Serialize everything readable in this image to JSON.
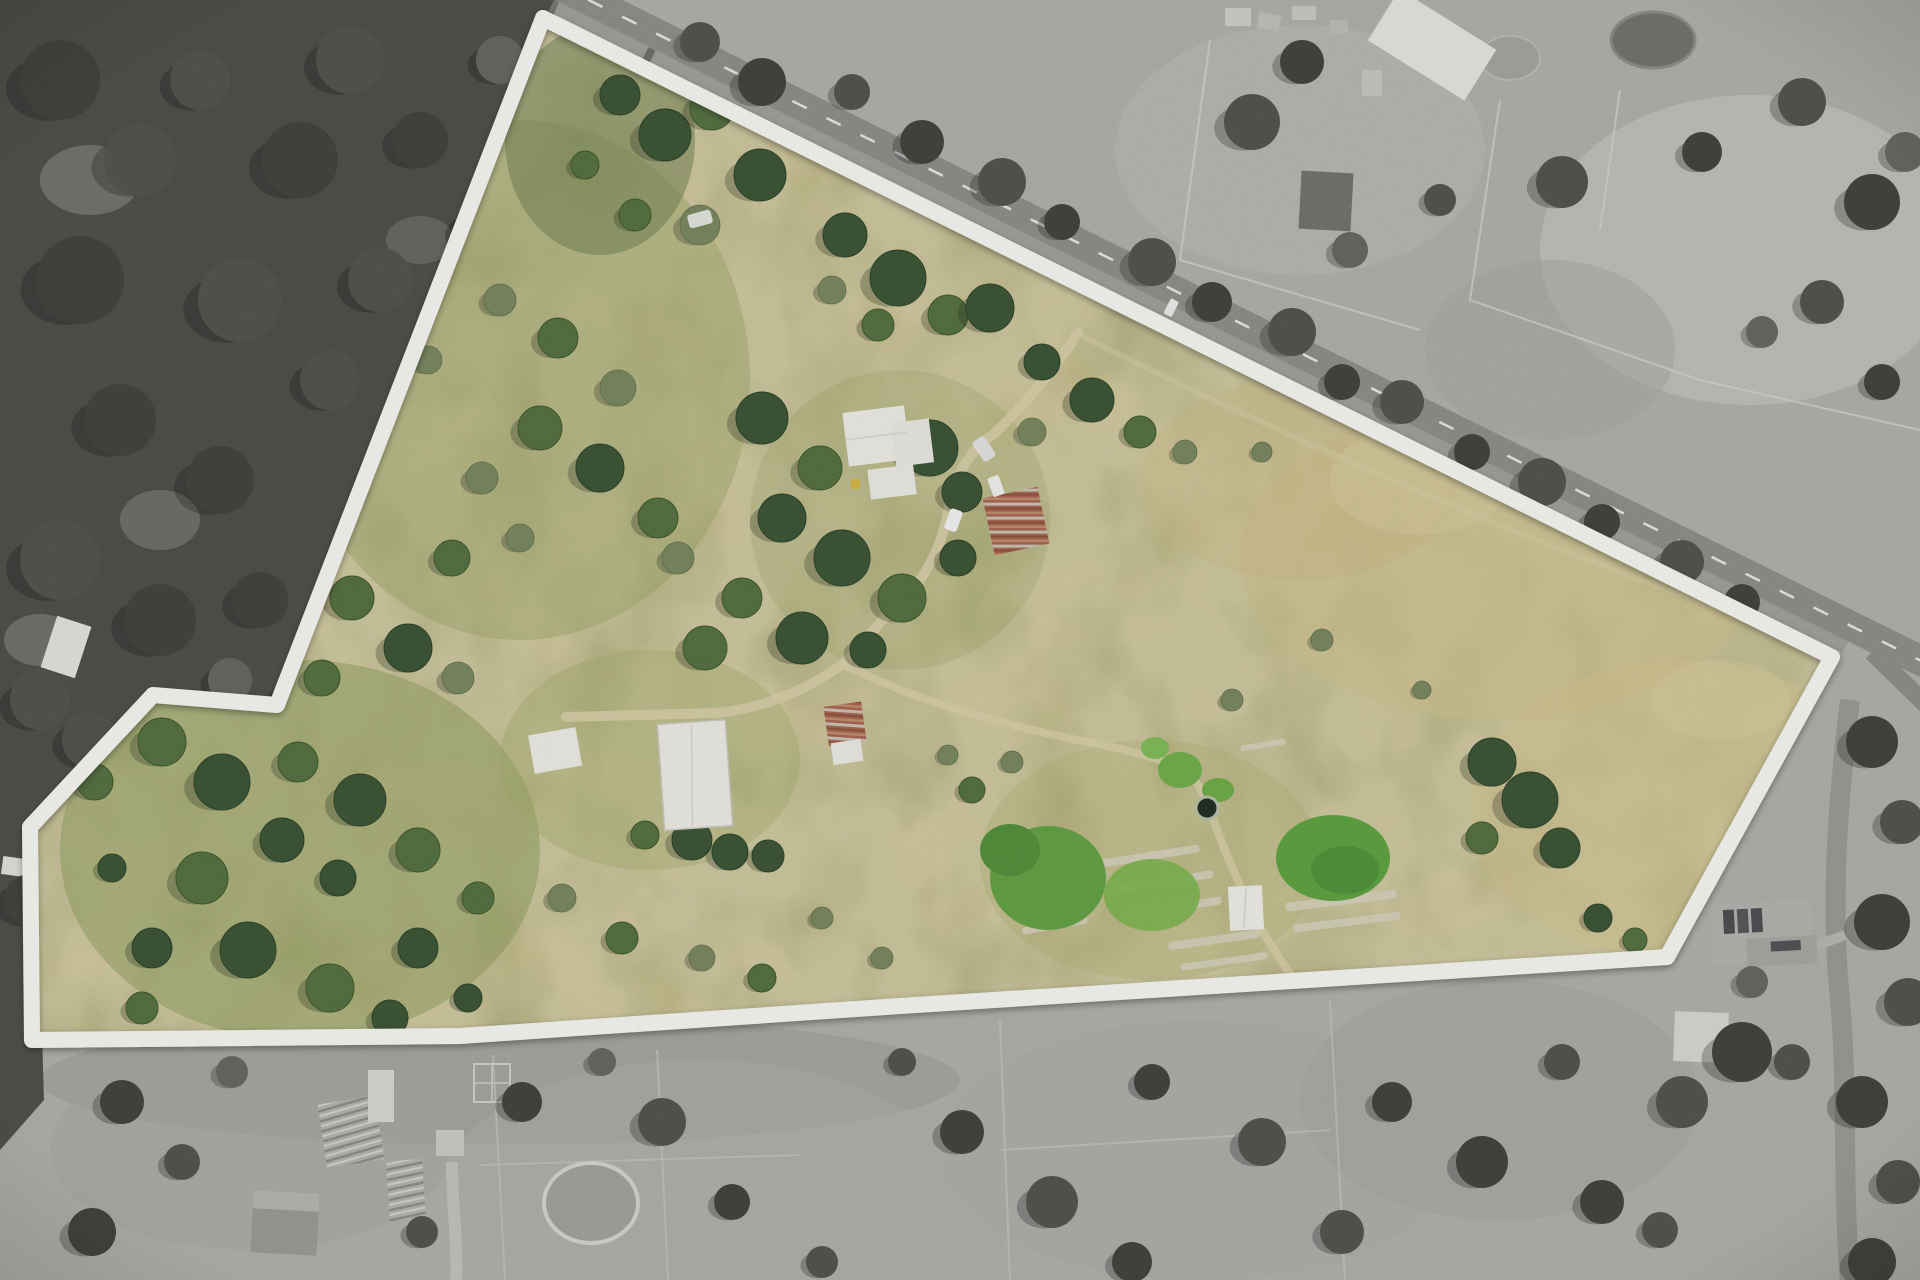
{
  "image": {
    "title": "Aerial drone photograph of a rural acreage lot; land inside the white marked boundary shown in colour, surrounding properties desaturated to greyscale",
    "kind": "real-estate aerial boundary photo"
  },
  "boundary": {
    "points": "543,18 1832,657 1667,957 900,1006 460,1036 32,1040 30,827 153,695 277,705",
    "stroke": "#fdfdf9",
    "stroke_width": 16
  },
  "palette": {
    "pasture_base": "#c6b67e",
    "pasture_dry": "#d6c68e",
    "pasture_olive": "#97a35e",
    "irrigated_green": "#58a338",
    "tree_dark": "#324f2b",
    "tree_mid": "#4e6d39",
    "scrub_grey_green": "#75855a",
    "track_tan": "#ddd2a8",
    "roof_white": "#f3f2ec",
    "rust_roof": "#a8604a",
    "outside_field": "#b3b1ac",
    "outside_forest": "#474743",
    "road_grey": "#8e8c88",
    "boundary_white": "#fdfdf9"
  },
  "features": [
    {
      "id": "boundary-outline",
      "label": "white surveyed property boundary"
    },
    {
      "id": "road-frontage",
      "label": "bitumen road along north-east boundary"
    },
    {
      "id": "main-house",
      "label": "white-roofed homestead with garage"
    },
    {
      "id": "rustic-shed-house",
      "label": "rusty corrugated shed beside homestead"
    },
    {
      "id": "big-barn",
      "label": "large white machinery barn"
    },
    {
      "id": "small-shed-west",
      "label": "small white shed west of barn"
    },
    {
      "id": "rustic-shed-mid",
      "label": "rusty shed with white lean-to mid paddock"
    },
    {
      "id": "garden-shed",
      "label": "small white garden shed"
    },
    {
      "id": "water-tank",
      "label": "round water tank beside garden"
    },
    {
      "id": "market-garden",
      "label": "irrigated green garden patches and crop beds"
    },
    {
      "id": "driveway",
      "label": "gravel driveway from road to homestead and barn"
    },
    {
      "id": "forest-west",
      "label": "dense bushland west of the lot (greyscale)"
    },
    {
      "id": "farm-complex-north",
      "label": "neighbouring farm buildings north of road (greyscale)"
    },
    {
      "id": "neighbour-house-east",
      "label": "neighbouring house with solar panels south-east (greyscale)"
    },
    {
      "id": "round-yard-south",
      "label": "round stock yard on southern neighbour (greyscale)"
    },
    {
      "id": "white-tarp",
      "label": "white tarp on ground near north boundary"
    },
    {
      "id": "cars",
      "label": "parked cars near homestead and on road"
    }
  ],
  "paths": {
    "driveway": "M1078,332 C1048,382 1008,420 994,434 C958,458 952,492 946,522 C936,560 918,586 903,600 C878,622 858,650 843,664 C798,696 758,708 718,713 L566,717",
    "garden_track": "M843,664 C918,702 1000,724 1078,740 C1138,752 1180,762 1196,782 C1210,802 1216,832 1230,862 C1244,896 1258,932 1298,984",
    "paddock_track": "M1082,336 C1252,422 1502,532 1702,602 C1762,624 1802,642 1824,656",
    "south_driveway": "M452,1162 C452,1205 458,1245 456,1285"
  },
  "trees": {
    "inside": [
      [
        620,
        95,
        20,
        "d"
      ],
      [
        665,
        135,
        26,
        "d"
      ],
      [
        712,
        108,
        22,
        "m"
      ],
      [
        760,
        175,
        26,
        "d"
      ],
      [
        700,
        225,
        20,
        "g"
      ],
      [
        635,
        215,
        16,
        "m"
      ],
      [
        585,
        165,
        14,
        "m"
      ],
      [
        845,
        235,
        22,
        "d"
      ],
      [
        898,
        278,
        28,
        "d"
      ],
      [
        948,
        315,
        20,
        "m"
      ],
      [
        878,
        325,
        16,
        "m"
      ],
      [
        990,
        308,
        24,
        "d"
      ],
      [
        832,
        290,
        14,
        "g"
      ],
      [
        1042,
        362,
        18,
        "d"
      ],
      [
        1092,
        400,
        22,
        "d"
      ],
      [
        1140,
        432,
        16,
        "m"
      ],
      [
        1032,
        432,
        14,
        "g"
      ],
      [
        1185,
        452,
        12,
        "g"
      ],
      [
        1262,
        452,
        10,
        "g"
      ],
      [
        500,
        300,
        16,
        "g"
      ],
      [
        558,
        338,
        20,
        "m"
      ],
      [
        618,
        388,
        18,
        "g"
      ],
      [
        540,
        428,
        22,
        "m"
      ],
      [
        482,
        478,
        16,
        "g"
      ],
      [
        600,
        468,
        24,
        "d"
      ],
      [
        658,
        518,
        20,
        "m"
      ],
      [
        520,
        538,
        14,
        "g"
      ],
      [
        452,
        558,
        18,
        "m"
      ],
      [
        678,
        558,
        16,
        "g"
      ],
      [
        428,
        360,
        14,
        "g"
      ],
      [
        762,
        418,
        26,
        "d"
      ],
      [
        820,
        468,
        22,
        "m"
      ],
      [
        930,
        448,
        28,
        "d"
      ],
      [
        962,
        492,
        20,
        "d"
      ],
      [
        782,
        518,
        24,
        "d"
      ],
      [
        842,
        558,
        28,
        "d"
      ],
      [
        902,
        598,
        24,
        "m"
      ],
      [
        958,
        558,
        18,
        "d"
      ],
      [
        742,
        598,
        20,
        "m"
      ],
      [
        802,
        638,
        26,
        "d"
      ],
      [
        868,
        650,
        18,
        "d"
      ],
      [
        705,
        648,
        22,
        "m"
      ],
      [
        692,
        840,
        20,
        "d"
      ],
      [
        730,
        852,
        18,
        "d"
      ],
      [
        768,
        856,
        16,
        "d"
      ],
      [
        645,
        835,
        14,
        "m"
      ],
      [
        162,
        742,
        24,
        "m"
      ],
      [
        222,
        782,
        28,
        "d"
      ],
      [
        298,
        762,
        20,
        "m"
      ],
      [
        360,
        800,
        26,
        "d"
      ],
      [
        282,
        840,
        22,
        "d"
      ],
      [
        202,
        878,
        26,
        "m"
      ],
      [
        338,
        878,
        18,
        "d"
      ],
      [
        418,
        850,
        22,
        "m"
      ],
      [
        152,
        948,
        20,
        "d"
      ],
      [
        248,
        950,
        28,
        "d"
      ],
      [
        330,
        988,
        24,
        "m"
      ],
      [
        418,
        948,
        20,
        "d"
      ],
      [
        478,
        898,
        16,
        "m"
      ],
      [
        142,
        1008,
        16,
        "m"
      ],
      [
        390,
        1018,
        18,
        "d"
      ],
      [
        468,
        998,
        14,
        "d"
      ],
      [
        95,
        782,
        18,
        "m"
      ],
      [
        112,
        868,
        14,
        "d"
      ],
      [
        352,
        598,
        22,
        "m"
      ],
      [
        408,
        648,
        24,
        "d"
      ],
      [
        322,
        678,
        18,
        "m"
      ],
      [
        458,
        678,
        16,
        "g"
      ],
      [
        1492,
        762,
        24,
        "d"
      ],
      [
        1530,
        800,
        28,
        "d"
      ],
      [
        1560,
        848,
        20,
        "d"
      ],
      [
        1482,
        838,
        16,
        "m"
      ],
      [
        1598,
        918,
        14,
        "d"
      ],
      [
        1635,
        940,
        12,
        "m"
      ],
      [
        1322,
        640,
        11,
        "g"
      ],
      [
        1422,
        690,
        9,
        "g"
      ],
      [
        1232,
        700,
        11,
        "g"
      ],
      [
        622,
        938,
        16,
        "m"
      ],
      [
        702,
        958,
        13,
        "g"
      ],
      [
        562,
        898,
        14,
        "g"
      ],
      [
        822,
        918,
        11,
        "g"
      ],
      [
        762,
        978,
        14,
        "m"
      ],
      [
        882,
        958,
        11,
        "g"
      ],
      [
        972,
        790,
        13,
        "m"
      ],
      [
        1012,
        762,
        11,
        "g"
      ],
      [
        948,
        755,
        10,
        "g"
      ]
    ],
    "outside": [
      [
        60,
        80,
        40,
        1
      ],
      [
        140,
        160,
        36,
        2
      ],
      [
        80,
        280,
        44,
        1
      ],
      [
        200,
        80,
        30,
        2
      ],
      [
        300,
        160,
        38,
        1
      ],
      [
        240,
        300,
        42,
        2
      ],
      [
        120,
        420,
        36,
        1
      ],
      [
        60,
        560,
        40,
        2
      ],
      [
        220,
        480,
        34,
        1
      ],
      [
        330,
        380,
        30,
        2
      ],
      [
        160,
        620,
        36,
        1
      ],
      [
        40,
        700,
        30,
        2
      ],
      [
        260,
        600,
        28,
        1
      ],
      [
        380,
        280,
        32,
        2
      ],
      [
        420,
        140,
        28,
        1
      ],
      [
        350,
        60,
        34,
        2
      ],
      [
        440,
        420,
        26,
        2
      ],
      [
        300,
        700,
        26,
        1
      ],
      [
        90,
        740,
        28,
        2
      ],
      [
        30,
        900,
        26,
        1
      ],
      [
        120,
        960,
        22,
        2
      ],
      [
        60,
        1010,
        20,
        1
      ],
      [
        230,
        680,
        22,
        3
      ],
      [
        400,
        500,
        24,
        3
      ],
      [
        480,
        230,
        26,
        3
      ],
      [
        500,
        60,
        24,
        3
      ],
      [
        700,
        42,
        20,
        2
      ],
      [
        762,
        82,
        24,
        1
      ],
      [
        852,
        92,
        18,
        2
      ],
      [
        922,
        142,
        22,
        1
      ],
      [
        1002,
        182,
        24,
        2
      ],
      [
        1062,
        222,
        18,
        1
      ],
      [
        1152,
        262,
        24,
        2
      ],
      [
        1212,
        302,
        20,
        1
      ],
      [
        1292,
        332,
        24,
        2
      ],
      [
        1342,
        382,
        18,
        1
      ],
      [
        1402,
        402,
        22,
        2
      ],
      [
        1472,
        452,
        18,
        1
      ],
      [
        1542,
        482,
        24,
        2
      ],
      [
        1602,
        522,
        18,
        1
      ],
      [
        1682,
        562,
        22,
        2
      ],
      [
        1742,
        602,
        18,
        1
      ],
      [
        1252,
        122,
        28,
        2
      ],
      [
        1302,
        62,
        22,
        1
      ],
      [
        1562,
        182,
        26,
        2
      ],
      [
        1702,
        152,
        20,
        1
      ],
      [
        1802,
        102,
        24,
        2
      ],
      [
        1872,
        202,
        28,
        1
      ],
      [
        1822,
        302,
        22,
        2
      ],
      [
        1882,
        382,
        18,
        1
      ],
      [
        1762,
        332,
        16,
        3
      ],
      [
        1905,
        152,
        20,
        3
      ],
      [
        1350,
        250,
        18,
        3
      ],
      [
        1440,
        200,
        16,
        2
      ],
      [
        1872,
        742,
        26,
        1
      ],
      [
        1902,
        822,
        22,
        2
      ],
      [
        1882,
        922,
        28,
        1
      ],
      [
        1908,
        1002,
        24,
        2
      ],
      [
        1862,
        1102,
        26,
        1
      ],
      [
        1898,
        1182,
        22,
        2
      ],
      [
        1872,
        1262,
        24,
        1
      ],
      [
        1792,
        1062,
        18,
        2
      ],
      [
        1742,
        1052,
        30,
        1
      ],
      [
        1682,
        1102,
        26,
        2
      ],
      [
        1752,
        982,
        16,
        3
      ],
      [
        1602,
        1202,
        22,
        1
      ],
      [
        1660,
        1230,
        18,
        2
      ],
      [
        122,
        1102,
        22,
        1
      ],
      [
        182,
        1162,
        18,
        2
      ],
      [
        92,
        1232,
        24,
        1
      ],
      [
        422,
        1232,
        16,
        2
      ],
      [
        522,
        1102,
        20,
        1
      ],
      [
        662,
        1122,
        24,
        2
      ],
      [
        732,
        1202,
        18,
        1
      ],
      [
        902,
        1062,
        14,
        2
      ],
      [
        962,
        1132,
        22,
        1
      ],
      [
        1052,
        1202,
        26,
        2
      ],
      [
        1152,
        1082,
        18,
        1
      ],
      [
        1262,
        1142,
        24,
        2
      ],
      [
        1392,
        1102,
        20,
        1
      ],
      [
        1342,
        1232,
        22,
        2
      ],
      [
        1482,
        1162,
        26,
        1
      ],
      [
        1562,
        1062,
        18,
        2
      ],
      [
        232,
        1072,
        16,
        3
      ],
      [
        1132,
        1262,
        20,
        1
      ],
      [
        822,
        1262,
        16,
        2
      ],
      [
        602,
        1062,
        14,
        3
      ]
    ]
  },
  "garden_beds": [
    [
      1100,
      852,
      100,
      8,
      -9
    ],
    [
      1110,
      878,
      104,
      8,
      -9
    ],
    [
      1122,
      904,
      100,
      8,
      -9
    ],
    [
      1285,
      896,
      112,
      9,
      -7
    ],
    [
      1293,
      918,
      108,
      8,
      -7
    ],
    [
      1168,
      936,
      92,
      8,
      -8
    ],
    [
      1180,
      958,
      88,
      7,
      -8
    ],
    [
      1010,
      900,
      70,
      7,
      -10
    ],
    [
      1022,
      922,
      66,
      7,
      -10
    ],
    [
      1240,
      742,
      46,
      6,
      -9
    ]
  ]
}
